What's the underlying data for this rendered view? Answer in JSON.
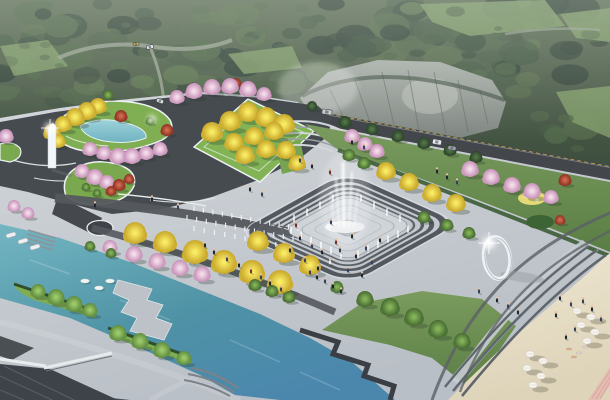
{
  "meta": {
    "title": "Aerial rendering of waterfront park plaza",
    "canvas": {
      "w": 610,
      "h": 400
    }
  },
  "palette": {
    "forest_top": "#5c6c54",
    "forest_bottom": "#38483a",
    "forest_blobs": [
      "#3e5140",
      "#475c45",
      "#52684b",
      "#35453a",
      "#5d7350"
    ],
    "meadow": "#7f9a68",
    "forest_road": "#97a191",
    "cliff_top": "#aab0aa",
    "cliff_bottom": "#7d837e",
    "cliff_shade": "#6b716c",
    "cliff_light": "#c3c7c2",
    "road": "#43474b",
    "road_curb_yellow": "#d4b64e",
    "guardrail": "#8f959a",
    "plaza_top": "#d3d7db",
    "plaza_bottom": "#b9bfc6",
    "plaza_band": "#55595e",
    "plaza_white": "#eceff1",
    "garden_road": "#464b4f",
    "lawn": "#7fae52",
    "lawn_deep": "#5d8440",
    "slope_top": "#7b9b5e",
    "slope_bottom": "#597e45",
    "hedge": "#3c5c35",
    "shrub": "#2f4f2c",
    "water_1": "#74b6c2",
    "water_2": "#4f93a6",
    "water_3": "#4b87ad",
    "pond_1": "#9ed2da",
    "pond_2": "#6fb3c0",
    "sand_1": "#efe7d2",
    "sand_2": "#ded4ba",
    "sand_shadow": "#8d8572",
    "pink_path": "#e4b9b1",
    "roof_dark": "#3e434a",
    "roof_mid": "#4a4f54",
    "beam_white": "#e9eced",
    "steps_dark": "#60666c",
    "steps_light": "#a2a9b0",
    "tree_ginkgo": [
      "#f8ea62",
      "#c7a62a"
    ],
    "tree_cherry": [
      "#f4dcea",
      "#c791b8"
    ],
    "tree_maple": [
      "#d06a4e",
      "#8c3122"
    ],
    "tree_green": [
      "#84b258",
      "#466b31"
    ],
    "tree_dgreen": [
      "#527449",
      "#2c4429"
    ],
    "tree_lgreen": [
      "#9cc96a",
      "#5f8c3f"
    ],
    "trunk": "#4d3b2b",
    "tree_shadow": "#2c3a2c",
    "white": "#ffffff",
    "sculpture": "#f3f6f8",
    "people": {
      "c1": "#20262e",
      "c2": "#37425a",
      "c3": "#7c2e28",
      "c4": "#e8eaee",
      "c5": "#2e4a38",
      "c6": "#5a4a6a"
    },
    "skin": "#e3c2a2",
    "sunbather": [
      "#e0b090",
      "#d8dade"
    ],
    "boat": "#eef1f3",
    "lilypad": "#f3f5f2",
    "umbrella": "#f6f4ee"
  },
  "scene": {
    "forest_boundary": [
      [
        0,
        118
      ],
      [
        60,
        108
      ],
      [
        120,
        100
      ],
      [
        200,
        92
      ],
      [
        260,
        96
      ],
      [
        300,
        98
      ],
      [
        360,
        64
      ],
      [
        430,
        58
      ],
      [
        500,
        92
      ],
      [
        545,
        135
      ],
      [
        580,
        160
      ],
      [
        610,
        178
      ]
    ],
    "trees": [
      [
        52,
        132,
        8,
        "ginkgo"
      ],
      [
        63,
        124,
        8,
        "ginkgo"
      ],
      [
        75,
        117,
        9,
        "ginkgo"
      ],
      [
        87,
        111,
        9,
        "ginkgo"
      ],
      [
        98,
        106,
        8,
        "ginkgo"
      ],
      [
        58,
        141,
        7,
        "ginkgo"
      ],
      [
        6,
        136,
        7,
        "cherry"
      ],
      [
        90,
        149,
        7,
        "cherry"
      ],
      [
        104,
        153,
        7,
        "cherry"
      ],
      [
        118,
        156,
        8,
        "cherry"
      ],
      [
        132,
        156,
        8,
        "cherry"
      ],
      [
        146,
        153,
        7,
        "cherry"
      ],
      [
        160,
        149,
        7,
        "cherry"
      ],
      [
        121,
        116,
        6,
        "maple"
      ],
      [
        167,
        130,
        6,
        "maple"
      ],
      [
        108,
        95,
        5,
        "green"
      ],
      [
        150,
        121,
        4,
        "green"
      ],
      [
        82,
        171,
        7,
        "cherry"
      ],
      [
        95,
        177,
        8,
        "cherry"
      ],
      [
        107,
        182,
        7,
        "cherry"
      ],
      [
        119,
        185,
        6,
        "maple"
      ],
      [
        129,
        179,
        5,
        "maple"
      ],
      [
        111,
        191,
        5,
        "maple"
      ],
      [
        97,
        193,
        4,
        "green"
      ],
      [
        86,
        187,
        4,
        "green"
      ],
      [
        177,
        97,
        7,
        "cherry"
      ],
      [
        194,
        91,
        8,
        "cherry"
      ],
      [
        212,
        87,
        8,
        "cherry"
      ],
      [
        230,
        86,
        8,
        "cherry"
      ],
      [
        248,
        89,
        8,
        "cherry"
      ],
      [
        264,
        94,
        7,
        "cherry"
      ],
      [
        236,
        83,
        5,
        "maple"
      ],
      [
        212,
        132,
        10,
        "ginkgo"
      ],
      [
        230,
        121,
        10,
        "ginkgo"
      ],
      [
        248,
        112,
        10,
        "ginkgo"
      ],
      [
        266,
        117,
        10,
        "ginkgo"
      ],
      [
        284,
        124,
        10,
        "ginkgo"
      ],
      [
        234,
        142,
        9,
        "ginkgo"
      ],
      [
        254,
        136,
        9,
        "ginkgo"
      ],
      [
        274,
        131,
        9,
        "ginkgo"
      ],
      [
        245,
        155,
        9,
        "ginkgo"
      ],
      [
        266,
        149,
        9,
        "ginkgo"
      ],
      [
        286,
        150,
        9,
        "ginkgo"
      ],
      [
        297,
        163,
        8,
        "ginkgo"
      ],
      [
        352,
        136,
        7,
        "cherry"
      ],
      [
        365,
        144,
        7,
        "cherry"
      ],
      [
        377,
        151,
        7,
        "cherry"
      ],
      [
        312,
        106,
        5,
        "dgreen"
      ],
      [
        345,
        122,
        6,
        "dgreen"
      ],
      [
        372,
        129,
        6,
        "dgreen"
      ],
      [
        398,
        136,
        6,
        "dgreen"
      ],
      [
        424,
        143,
        6,
        "dgreen"
      ],
      [
        450,
        150,
        6,
        "dgreen"
      ],
      [
        476,
        157,
        6,
        "dgreen"
      ],
      [
        470,
        169,
        8,
        "cherry"
      ],
      [
        491,
        177,
        8,
        "cherry"
      ],
      [
        512,
        185,
        8,
        "cherry"
      ],
      [
        532,
        191,
        8,
        "cherry"
      ],
      [
        551,
        197,
        7,
        "cherry"
      ],
      [
        565,
        180,
        6,
        "maple"
      ],
      [
        560,
        220,
        5,
        "maple"
      ],
      [
        258,
        241,
        10,
        "ginkgo"
      ],
      [
        284,
        253,
        10,
        "ginkgo"
      ],
      [
        310,
        265,
        10,
        "ginkgo"
      ],
      [
        386,
        171,
        9,
        "ginkgo"
      ],
      [
        409,
        182,
        9,
        "ginkgo"
      ],
      [
        432,
        193,
        9,
        "ginkgo"
      ],
      [
        456,
        203,
        9,
        "ginkgo"
      ],
      [
        349,
        155,
        6,
        "green"
      ],
      [
        364,
        163,
        6,
        "green"
      ],
      [
        424,
        217,
        6,
        "green"
      ],
      [
        447,
        225,
        6,
        "green"
      ],
      [
        469,
        233,
        6,
        "green"
      ],
      [
        337,
        287,
        6,
        "green"
      ],
      [
        135,
        233,
        11,
        "ginkgo"
      ],
      [
        165,
        242,
        11,
        "ginkgo"
      ],
      [
        195,
        252,
        12,
        "ginkgo"
      ],
      [
        224,
        262,
        12,
        "ginkgo"
      ],
      [
        252,
        272,
        12,
        "ginkgo"
      ],
      [
        280,
        282,
        12,
        "ginkgo"
      ],
      [
        110,
        247,
        7,
        "cherry"
      ],
      [
        134,
        254,
        8,
        "cherry"
      ],
      [
        157,
        261,
        8,
        "cherry"
      ],
      [
        180,
        268,
        8,
        "cherry"
      ],
      [
        202,
        274,
        8,
        "cherry"
      ],
      [
        14,
        206,
        6,
        "cherry"
      ],
      [
        28,
        213,
        6,
        "cherry"
      ],
      [
        90,
        246,
        5,
        "green"
      ],
      [
        111,
        253,
        5,
        "green"
      ],
      [
        255,
        285,
        6,
        "green"
      ],
      [
        272,
        291,
        6,
        "green"
      ],
      [
        289,
        297,
        6,
        "green"
      ],
      [
        38,
        291,
        7,
        "lgreen"
      ],
      [
        56,
        297,
        8,
        "lgreen"
      ],
      [
        74,
        304,
        8,
        "lgreen"
      ],
      [
        90,
        310,
        7,
        "lgreen"
      ],
      [
        118,
        333,
        8,
        "lgreen"
      ],
      [
        140,
        341,
        8,
        "lgreen"
      ],
      [
        162,
        350,
        8,
        "lgreen"
      ],
      [
        184,
        358,
        7,
        "lgreen"
      ],
      [
        365,
        299,
        8,
        "green"
      ],
      [
        390,
        307,
        9,
        "green"
      ],
      [
        414,
        317,
        9,
        "green"
      ],
      [
        438,
        329,
        9,
        "green"
      ],
      [
        462,
        341,
        8,
        "green"
      ]
    ],
    "people": [
      [
        300,
        240,
        "c1"
      ],
      [
        312,
        248,
        "c2"
      ],
      [
        322,
        254,
        "c1"
      ],
      [
        296,
        227,
        "c3"
      ],
      [
        340,
        252,
        "c2"
      ],
      [
        356,
        258,
        "c1"
      ],
      [
        366,
        250,
        "c2"
      ],
      [
        380,
        242,
        "c1"
      ],
      [
        330,
        264,
        "c4"
      ],
      [
        318,
        270,
        "c1"
      ],
      [
        305,
        262,
        "c2"
      ],
      [
        290,
        252,
        "c1"
      ],
      [
        348,
        272,
        "c2"
      ],
      [
        362,
        277,
        "c1"
      ],
      [
        336,
        244,
        "c3"
      ],
      [
        372,
        264,
        "c2"
      ],
      [
        352,
        238,
        "c1"
      ],
      [
        331,
        224,
        "c2"
      ],
      [
        214,
        254,
        "c1"
      ],
      [
        227,
        261,
        "c2"
      ],
      [
        239,
        267,
        "c1"
      ],
      [
        251,
        273,
        "c3"
      ],
      [
        261,
        279,
        "c2"
      ],
      [
        205,
        247,
        "c1"
      ],
      [
        270,
        285,
        "c1"
      ],
      [
        281,
        291,
        "c2"
      ],
      [
        317,
        279,
        "c1"
      ],
      [
        325,
        283,
        "c2"
      ],
      [
        333,
        288,
        "c1"
      ],
      [
        310,
        274,
        "c2"
      ],
      [
        341,
        293,
        "c1"
      ],
      [
        352,
        144,
        "c1"
      ],
      [
        364,
        149,
        "c2"
      ],
      [
        447,
        179,
        "c1"
      ],
      [
        457,
        184,
        "c2"
      ],
      [
        437,
        173,
        "c1"
      ],
      [
        300,
        162,
        "c2"
      ],
      [
        312,
        168,
        "c1"
      ],
      [
        330,
        174,
        "c3"
      ],
      [
        497,
        302,
        "c1"
      ],
      [
        508,
        308,
        "c2"
      ],
      [
        518,
        314,
        "c1"
      ],
      [
        479,
        293,
        "c2"
      ],
      [
        560,
        300,
        "c1"
      ],
      [
        571,
        306,
        "c2"
      ],
      [
        556,
        317,
        "c1"
      ],
      [
        583,
        303,
        "c2"
      ],
      [
        592,
        311,
        "c1"
      ],
      [
        575,
        331,
        "c2"
      ],
      [
        566,
        339,
        "c1"
      ],
      [
        601,
        321,
        "c2"
      ],
      [
        250,
        191,
        "c1"
      ],
      [
        262,
        196,
        "c2"
      ],
      [
        152,
        201,
        "c1"
      ],
      [
        178,
        209,
        "c2"
      ],
      [
        95,
        207,
        "c1"
      ]
    ],
    "sunbathers": [
      [
        569,
        349
      ],
      [
        579,
        353
      ],
      [
        574,
        357
      ],
      [
        585,
        347
      ]
    ],
    "umbrellas": [
      [
        530,
        354
      ],
      [
        543,
        361
      ],
      [
        527,
        368
      ],
      [
        541,
        376
      ],
      [
        533,
        385
      ],
      [
        577,
        311
      ],
      [
        591,
        317
      ],
      [
        581,
        325
      ],
      [
        595,
        332
      ],
      [
        587,
        341
      ]
    ],
    "cars": [
      [
        327,
        112,
        10,
        5,
        "#c9ccce",
        8
      ],
      [
        437,
        142,
        9,
        5,
        "#e9ebed",
        10
      ],
      [
        452,
        148,
        8,
        4,
        "#9fa5aa",
        10
      ],
      [
        150,
        47,
        7,
        4,
        "#e2e4e6",
        -12
      ],
      [
        136,
        44,
        6,
        3,
        "#d2bc50",
        -12
      ],
      [
        160,
        101,
        7,
        4,
        "#dde0e2",
        20
      ]
    ],
    "boats": [
      [
        11,
        235
      ],
      [
        23,
        241
      ],
      [
        35,
        247
      ]
    ],
    "lilypads": [
      [
        85,
        281
      ],
      [
        99,
        288
      ],
      [
        110,
        281
      ]
    ],
    "fountain": {
      "center": [
        345,
        227
      ],
      "main_jets": [
        [
          344,
          227,
          343,
          163,
          2.6
        ],
        [
          339,
          227,
          336,
          178,
          1.6
        ],
        [
          349,
          227,
          352,
          172,
          1.6
        ],
        [
          334,
          227,
          331,
          192,
          1.1
        ],
        [
          354,
          227,
          358,
          190,
          1.1
        ]
      ],
      "perimeter_jets": [
        [
          291,
          233
        ],
        [
          301,
          238
        ],
        [
          311,
          243
        ],
        [
          321,
          248
        ],
        [
          331,
          253
        ],
        [
          341,
          258
        ],
        [
          358,
          257
        ],
        [
          368,
          252
        ],
        [
          378,
          247
        ],
        [
          388,
          242
        ],
        [
          398,
          237
        ],
        [
          408,
          232
        ],
        [
          294,
          221
        ],
        [
          307,
          215
        ],
        [
          320,
          208
        ],
        [
          333,
          201
        ],
        [
          361,
          201
        ],
        [
          374,
          208
        ],
        [
          387,
          215
        ],
        [
          400,
          221
        ]
      ],
      "dry_rows": [
        [
          194,
          211,
          298,
          231,
          12
        ],
        [
          187,
          220,
          293,
          241,
          12
        ],
        [
          194,
          231,
          286,
          249,
          10
        ]
      ]
    },
    "sculptures": {
      "pillar": [
        50,
        168
      ],
      "ring": [
        497,
        258
      ]
    }
  }
}
